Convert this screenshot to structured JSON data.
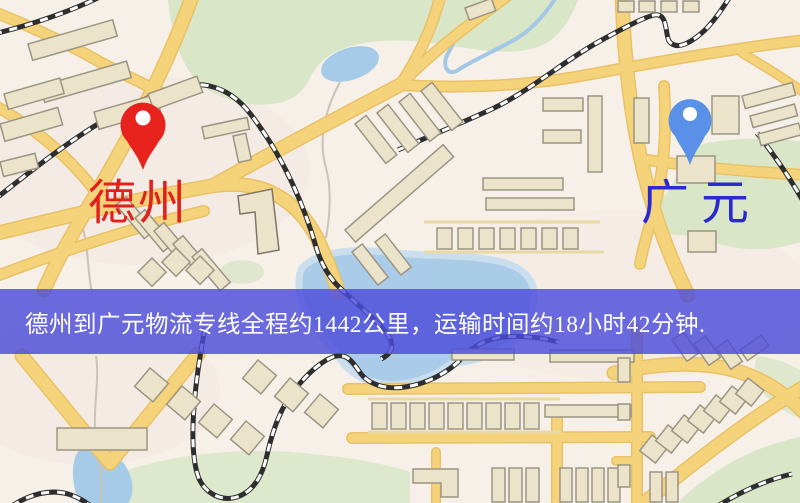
{
  "banner": {
    "text": "德州到广元物流专线全程约1442公里，运输时间约18小时42分钟.",
    "background": "#4c4cdb",
    "opacity": "0.82",
    "text_color": "#ffffff"
  },
  "markers": {
    "origin": {
      "label": "德州",
      "pin_color": "#e8231e",
      "label_color": "#e2211d"
    },
    "destination": {
      "label": "广元",
      "pin_color": "#5b90e8",
      "label_color": "#2a2ace"
    }
  },
  "route": {
    "from": "德州",
    "to": "广元",
    "service": "物流专线",
    "distance": "约1442公里",
    "duration": "约18小时42分钟"
  },
  "map_palette": {
    "background": "#f6f0e8",
    "road": "#f5d37a",
    "road_casing": "#e9c267",
    "building": "#ece3cb",
    "building_stroke": "#9b9583",
    "railway": "#2e2e2e",
    "green": "#d9e6c8",
    "water": "#a6cbe8"
  }
}
